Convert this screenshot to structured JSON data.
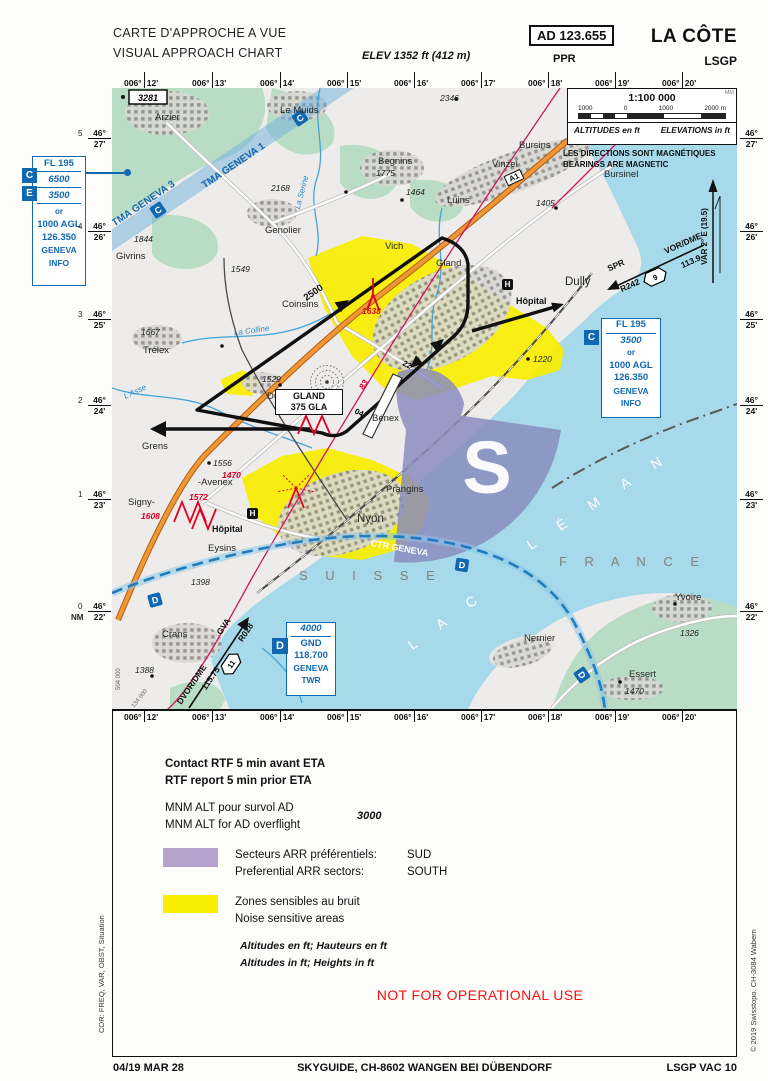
{
  "header": {
    "title_fr": "CARTE D'APPROCHE A VUE",
    "title_en": "VISUAL APPROACH CHART",
    "elev": "ELEV 1352 ft (412 m)",
    "ad": "AD 123.655",
    "ppr": "PPR",
    "airport": "LA CÔTE",
    "icao": "LSGP"
  },
  "grid": {
    "lon_deg": "006°",
    "lon": [
      "12'",
      "13'",
      "14'",
      "15'",
      "16'",
      "17'",
      "18'",
      "19'",
      "20'"
    ],
    "lat_deg": "46°",
    "lat": [
      "27'",
      "26'",
      "25'",
      "24'",
      "23'",
      "22'"
    ],
    "nm": [
      "5",
      "4",
      "3",
      "2",
      "1",
      "0"
    ],
    "nm_label": "NM",
    "grid_x": "504 000",
    "grid_y": "134 000"
  },
  "scalebox": {
    "mm": "MM",
    "scale": "1:100 000",
    "ticks": [
      "1000",
      "0",
      "1000",
      "2000 m"
    ],
    "alt_fr": "ALTITUDES en ft",
    "alt_en": "ELEVATIONS in ft"
  },
  "mag": {
    "fr": "LES DIRECTIONS SONT MAGNÉTIQUES",
    "en": "BEARINGS ARE MAGNETIC",
    "var": "VAR 2° E (19.5)"
  },
  "boxes": {
    "ce": {
      "c": "C",
      "e": "E",
      "fl": "FL 195",
      "upper": "6500",
      "lower": "3500",
      "or": "or",
      "agl": "1000 AGL",
      "freq": "126.350",
      "unit1": "GENEVA",
      "unit2": "INFO"
    },
    "c": {
      "cls": "C",
      "fl": "FL 195",
      "alt": "3500",
      "or": "or",
      "agl": "1000 AGL",
      "freq": "126.350",
      "unit1": "GENEVA",
      "unit2": "INFO"
    },
    "d": {
      "cls": "D",
      "alt": "4000",
      "gnd": "GND",
      "freq": "118.700",
      "unit1": "GENEVA",
      "unit2": "TWR"
    }
  },
  "nav": {
    "spr": {
      "route": "SPR",
      "radial": "R242",
      "dist": "9",
      "type": "VOR/DME",
      "freq": "113.9"
    },
    "gva": {
      "type": "DVOR/DME",
      "id": "GVA",
      "freq": "115.75",
      "dist": "11",
      "radial": "R028"
    },
    "gland": {
      "name": "GLAND",
      "freq": "375 GLA"
    },
    "rwy1": "22",
    "rwy2": "04",
    "circuit_alt": "2500"
  },
  "map": {
    "towns": {
      "arzier": "Arzier",
      "lemuids": "Le Muids",
      "begnins": "Begnins",
      "bursins": "Bursins",
      "vinzel": "Vinzel",
      "bursinel": "Bursinel",
      "luins": "Luins",
      "genolier": "Genolier",
      "givrins": "Givrins",
      "vich": "Vich",
      "gland": "Gland",
      "dully": "Dully",
      "coinsins": "Coinsins",
      "trelex": "Trélex",
      "duillier": "Duillier",
      "benex": "Bénex",
      "grens": "Grens",
      "avenex": "-Avenex",
      "signy": "Signy-",
      "eysins": "Eysins",
      "nyon": "Nyon",
      "prangins": "Prangins",
      "crans": "Crans",
      "nernier": "Nernier",
      "yvoire": "Yvoire",
      "essert": "Essert"
    },
    "spots": {
      "s2346": "2346",
      "s2168": "2168",
      "s1775": "1775",
      "s1464": "1464",
      "s1405": "1405",
      "s1844": "1844",
      "s1549": "1549",
      "s1667": "1667",
      "s1529": "1529",
      "s1556": "1556",
      "s1398": "1398",
      "s1388": "1388",
      "s1220": "1220",
      "s1326": "1326",
      "s1470": "1470"
    },
    "obstacles": {
      "o1638": "1638",
      "o1483": "1483",
      "o1470": "1470",
      "o1572": "1572",
      "o1608": "1608",
      "o83": "83",
      "box3281": "3281"
    },
    "rivers": {
      "serine": "La Serine",
      "colline": "La Colline",
      "asse": "L'Asse"
    },
    "areas": {
      "tma3": "TMA GENEVA 3",
      "tma1": "TMA GENEVA 1",
      "ctr": "CTR GENEVA",
      "suisse": "S U I S S E",
      "france": "F R A N C E",
      "lac": "L A C",
      "leman": "L É M A N",
      "sector": "S"
    },
    "classes": {
      "c": "C",
      "d": "D"
    },
    "hospital": "Hôpital",
    "a1": "A1"
  },
  "legend": {
    "rtf_fr": "Contact RTF 5 min avant ETA",
    "rtf_en": "RTF report 5 min prior ETA",
    "mnm_fr": "MNM ALT pour survol AD",
    "mnm_en": "MNM ALT for AD overflight",
    "mnm_val": "3000",
    "arr_fr_label": "Secteurs ARR préférentiels:",
    "arr_fr_val": "SUD",
    "arr_en_label": "Preferential ARR sectors:",
    "arr_en_val": "SOUTH",
    "noise_fr": "Zones sensibles au bruit",
    "noise_en": "Noise sensitive areas",
    "alt_fr": "Altitudes en ft; Hauteurs en ft",
    "alt_en": "Altitudes in ft;  Heights in ft",
    "warning": "NOT FOR OPERATIONAL USE"
  },
  "footer": {
    "date": "04/19 MAR 28",
    "publisher": "SKYGUIDE, CH-8602 WANGEN BEI DÜBENDORF",
    "page": "LSGP VAC 10"
  },
  "sides": {
    "left": "COR: FREQ, VAR, OBST, Situation",
    "right": "© 2019 Swisstopo. CH-3084 Wabern"
  }
}
